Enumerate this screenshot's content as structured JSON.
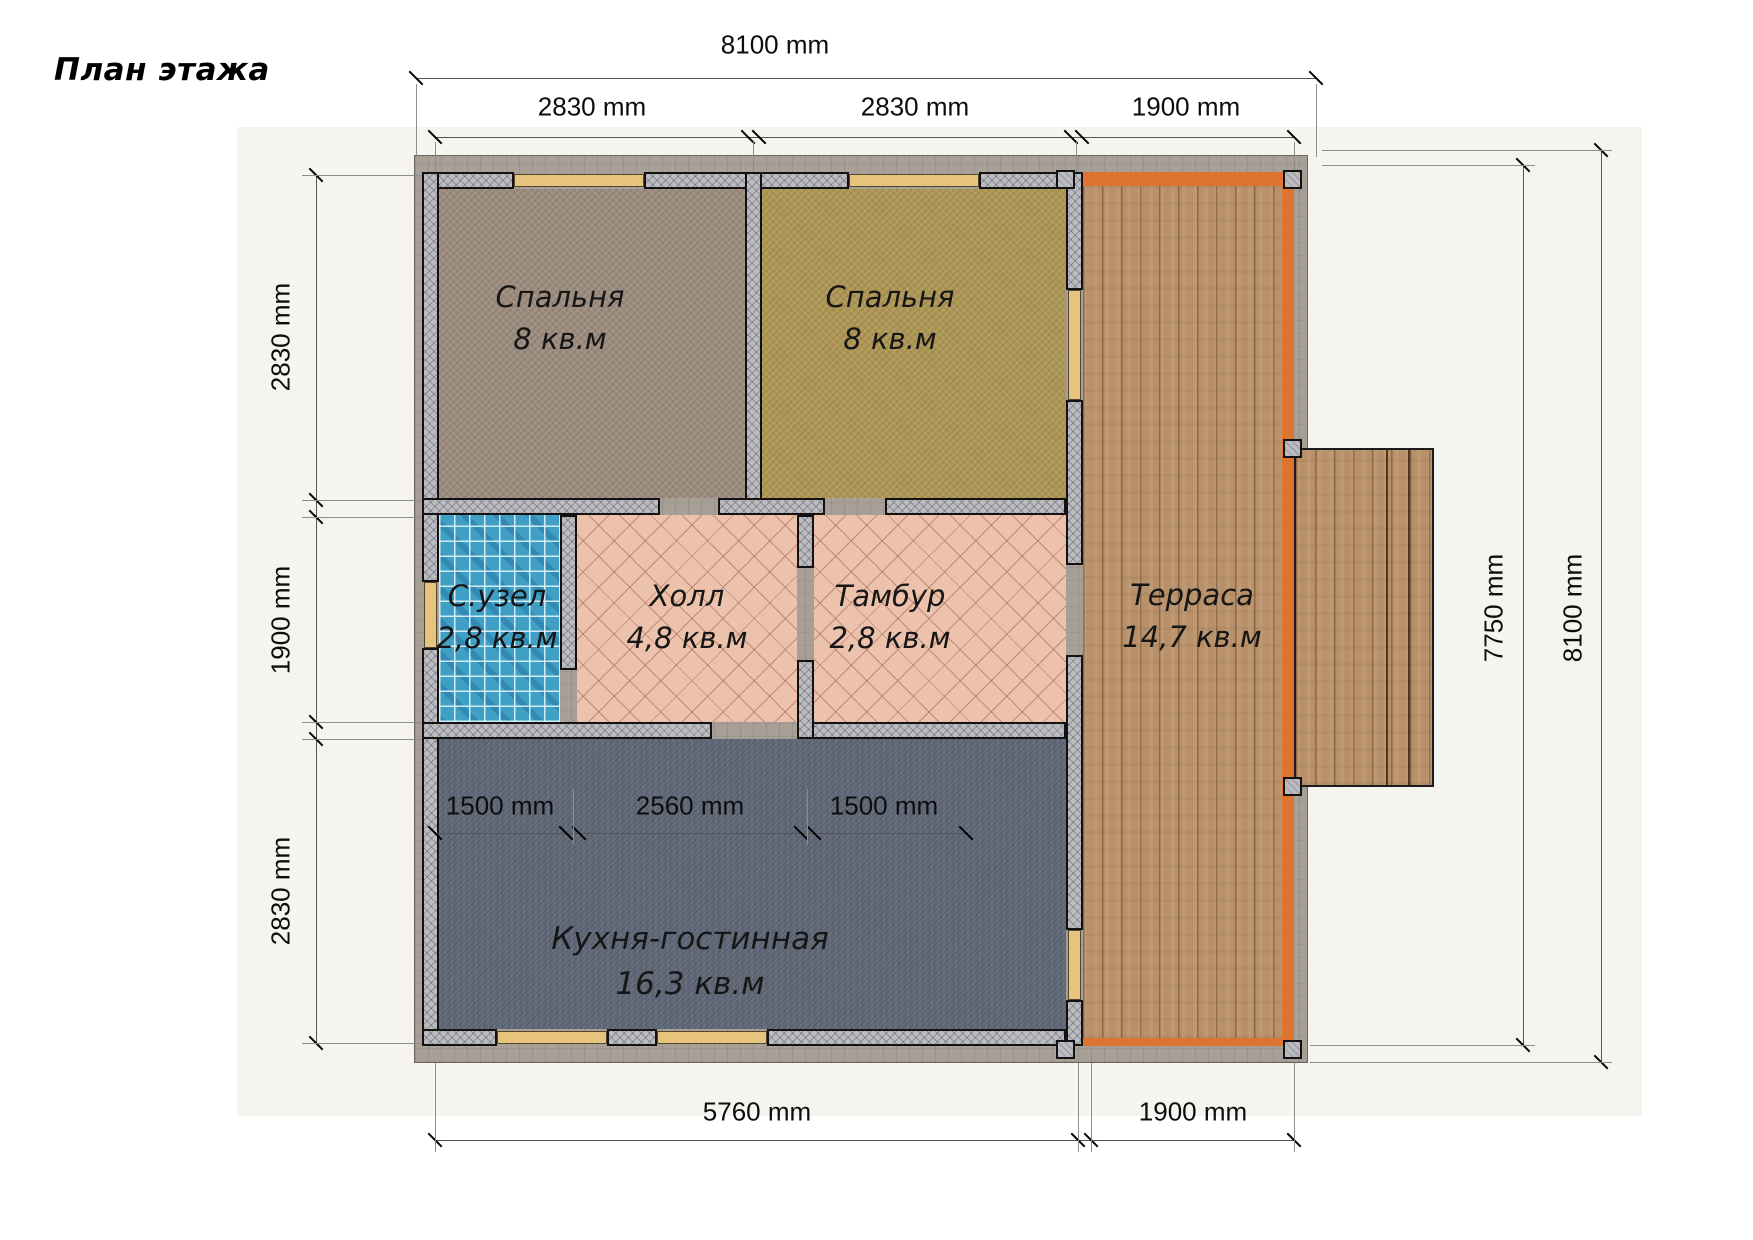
{
  "title": "План этажа",
  "rooms": [
    {
      "name": "Спальня",
      "area": "8 кв.м"
    },
    {
      "name": "Спальня",
      "area": "8 кв.м"
    },
    {
      "name": "С.узел",
      "area": "2,8 кв.м"
    },
    {
      "name": "Холл",
      "area": "4,8 кв.м"
    },
    {
      "name": "Тамбур",
      "area": "2,8 кв.м"
    },
    {
      "name": "Терраса",
      "area": "14,7 кв.м"
    },
    {
      "name": "Кухня-гостинная",
      "area": "16,3 кв.м"
    }
  ],
  "dims": {
    "top_total": "8100 mm",
    "top_segments": [
      "2830 mm",
      "2830 mm",
      "1900 mm"
    ],
    "left_segments": [
      "2830 mm",
      "1900 mm",
      "2830 mm"
    ],
    "right_inner": "7750 mm",
    "right_total": "8100 mm",
    "bottom_segments": [
      "5760 mm",
      "1900 mm"
    ],
    "kitchen_segments": [
      "1500 mm",
      "2560 mm",
      "1500 mm"
    ]
  },
  "colors": {
    "backdrop": "#f6f4ef",
    "siding": "#a8a096",
    "wall": "#bcbcc0",
    "window": "#e7c47d",
    "deck_edge": "#dd7430",
    "bathroom_tile": "#3f9fc4",
    "hall_tile": "#ecc2ac",
    "kitchen_floor": "#5e6675",
    "bedroom1_floor": "#9c8c7e",
    "bedroom2_floor": "#ae9755",
    "terrace_wood": "#b8906a",
    "dim_line": "#555555"
  }
}
